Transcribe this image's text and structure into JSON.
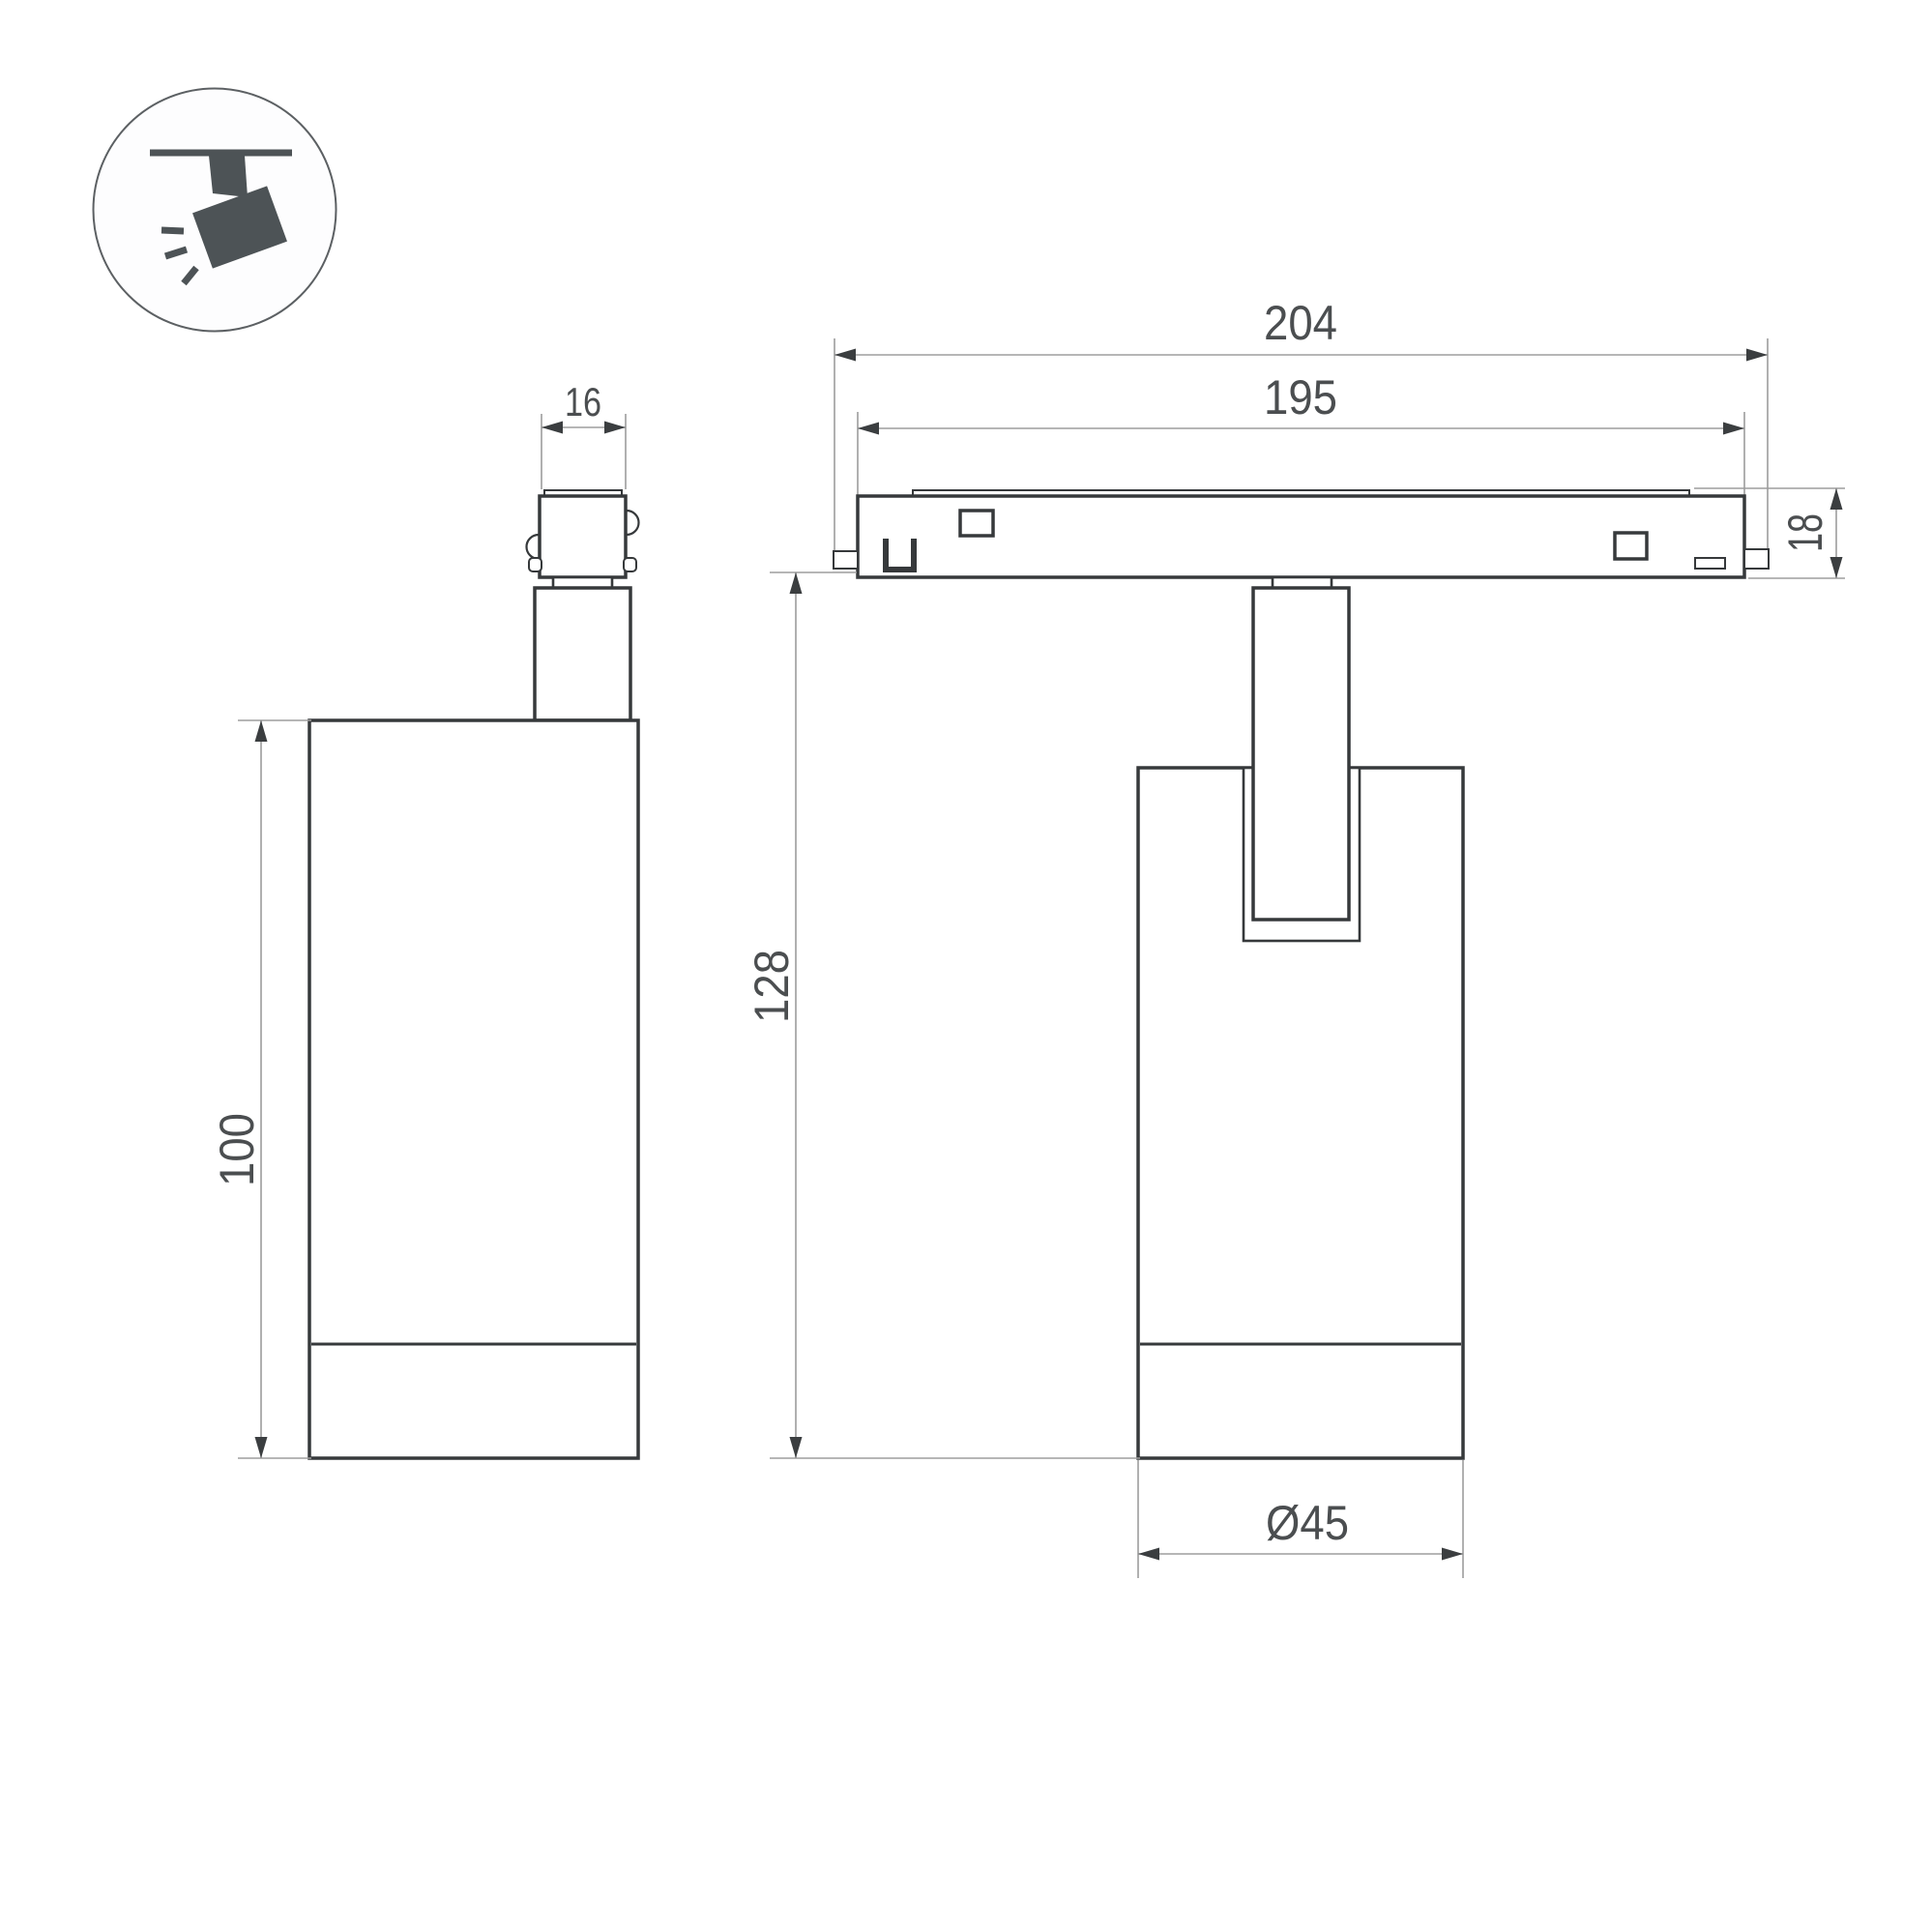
{
  "drawing": {
    "kind": "technical-dimension-drawing",
    "subject": "magnetic-track-spotlight",
    "colors": {
      "background": "#ffffff",
      "outline": "#36393b",
      "dimension_line": "#9d9d9d",
      "dimension_text": "#4b4e50",
      "icon": "#4d5356"
    },
    "icon": {
      "name": "ceiling-track-spotlight-icon"
    },
    "views": {
      "side": {
        "dimensions": {
          "adapter_width": "16",
          "body_height": "100"
        }
      },
      "front": {
        "dimensions": {
          "track_length_outer": "204",
          "track_length_inner": "195",
          "track_height": "18",
          "overall_height": "128",
          "body_diameter": "Ø45"
        }
      }
    }
  }
}
